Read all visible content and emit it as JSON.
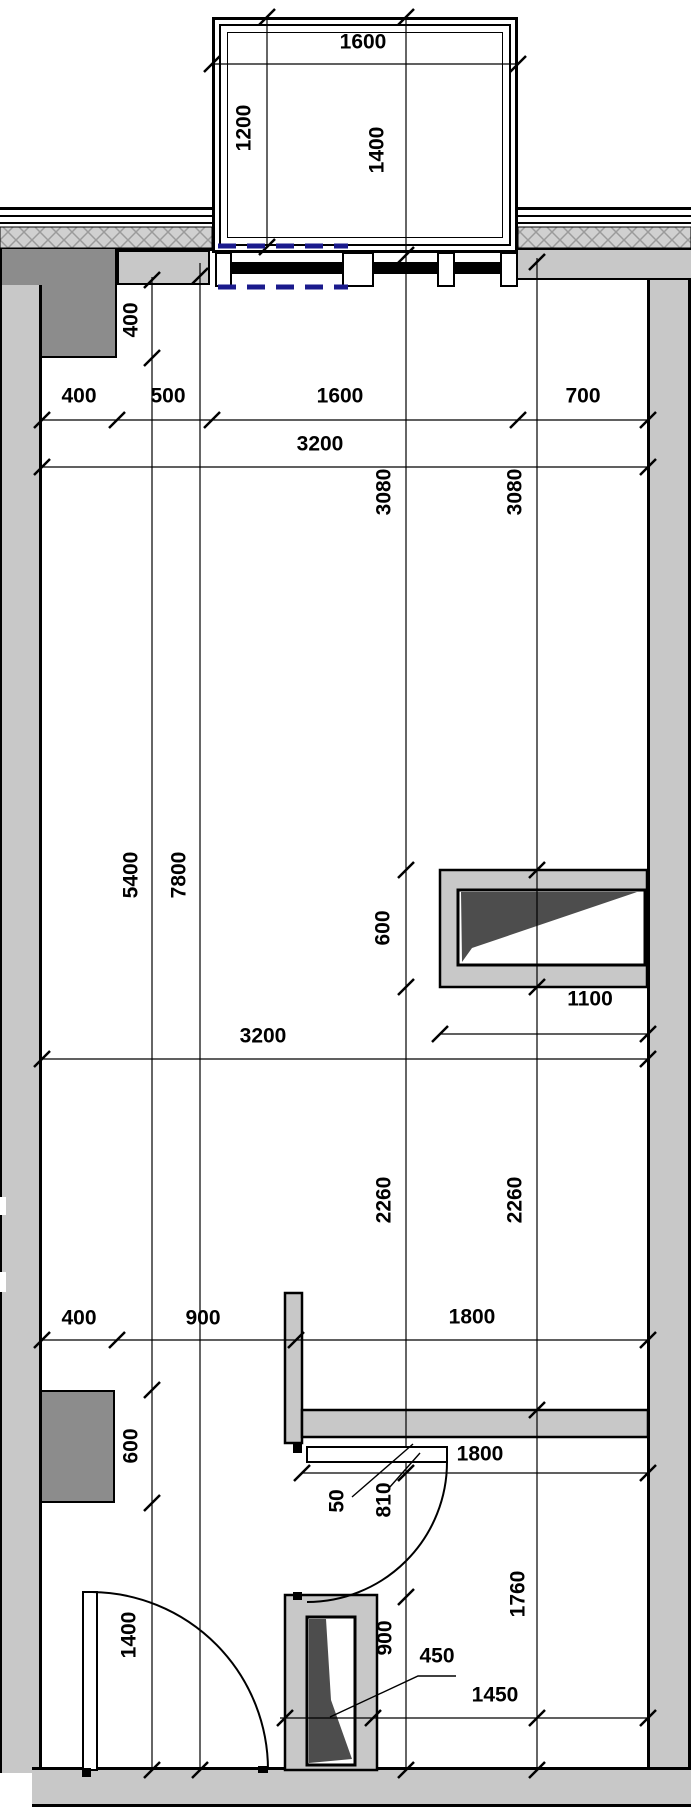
{
  "colors": {
    "wall": "#c8c8c8",
    "column": "#8c8c8c",
    "shaft": "#4d4d4d",
    "hatch_bg": "#d0d0d0",
    "hatch_line": "#9b9b9b",
    "dash_blue": "#1a1a8c",
    "line": "#000000"
  },
  "balcony": {
    "w": "1600",
    "dl": "1200",
    "dr": "1400"
  },
  "top_row": {
    "a": "400",
    "b": "500",
    "c": "1600",
    "d": "700",
    "total": "3200"
  },
  "left_col": {
    "a400": "400",
    "v5400": "5400",
    "v7800": "7800",
    "c600": "600",
    "d1400": "1400"
  },
  "middle": {
    "l3080": "3080",
    "r3080": "3080",
    "s600": "600",
    "s1100": "1100",
    "m3200": "3200",
    "l2260": "2260",
    "r2260": "2260"
  },
  "bottom": {
    "a400": "400",
    "b900": "900",
    "c1800": "1800",
    "d1800": "1800",
    "g50": "50",
    "leaf810": "810",
    "r1760": "1760",
    "s900": "900",
    "s450": "450",
    "w1450": "1450"
  }
}
